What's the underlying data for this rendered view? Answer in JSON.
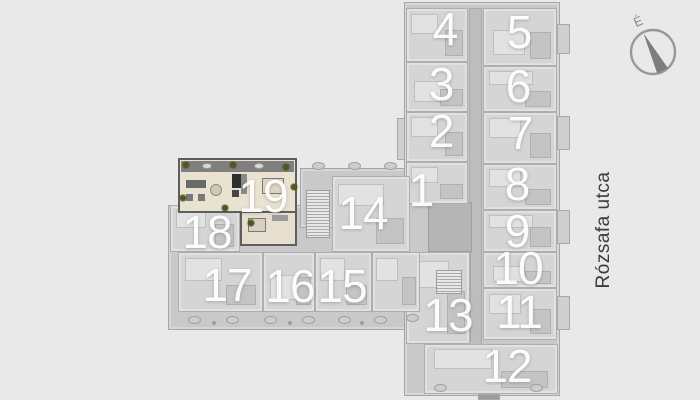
{
  "street": {
    "label": "Rózsafa utca"
  },
  "compass": {
    "north_label": "É"
  },
  "plan": {
    "highlighted_unit": "19",
    "units": [
      {
        "id": "unit-1",
        "label": "1"
      },
      {
        "id": "unit-2",
        "label": "2"
      },
      {
        "id": "unit-3",
        "label": "3"
      },
      {
        "id": "unit-4",
        "label": "4"
      },
      {
        "id": "unit-5",
        "label": "5"
      },
      {
        "id": "unit-6",
        "label": "6"
      },
      {
        "id": "unit-7",
        "label": "7"
      },
      {
        "id": "unit-8",
        "label": "8"
      },
      {
        "id": "unit-9",
        "label": "9"
      },
      {
        "id": "unit-10",
        "label": "10"
      },
      {
        "id": "unit-11",
        "label": "11"
      },
      {
        "id": "unit-12",
        "label": "12"
      },
      {
        "id": "unit-13",
        "label": "13"
      },
      {
        "id": "unit-14",
        "label": "14"
      },
      {
        "id": "unit-15",
        "label": "15"
      },
      {
        "id": "unit-16",
        "label": "16"
      },
      {
        "id": "unit-17",
        "label": "17"
      },
      {
        "id": "unit-18",
        "label": "18"
      },
      {
        "id": "unit-19",
        "label": "19"
      }
    ]
  },
  "colors": {
    "background": "#e9e9e9",
    "plan_base": "#c9c9c9",
    "unit_fill": "#d5d5d5",
    "corridor": "#bdbdbd",
    "highlight_floor": "#eae2d1",
    "highlight_wall": "#5e5e5e",
    "plant_green": "#4c5a20",
    "unit_number": "#ffffff",
    "street_text": "#3c3c3c"
  }
}
